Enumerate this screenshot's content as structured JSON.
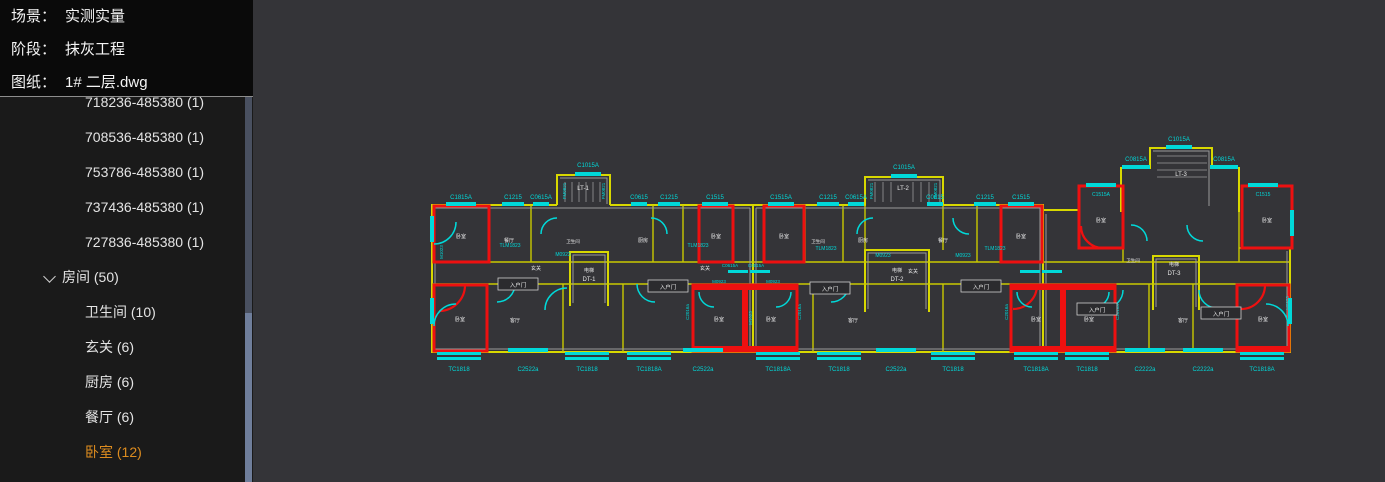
{
  "header": {
    "scene_label": "场景：",
    "scene_value": "实测实量",
    "stage_label": "阶段：",
    "stage_value": "抹灰工程",
    "drawing_label": "图纸：",
    "drawing_value": "1# 二层.dwg"
  },
  "theme": {
    "selected_item_color": "#dd8c1f",
    "sidebar_bg": "#1a1a1a",
    "canvas_bg": "#343438",
    "header_bg": "#0a0a0a",
    "cad_wall_yellow": "#d8d800",
    "cad_highlight_red": "#ee1010",
    "cad_window_cyan": "#00d9d9",
    "scrollbar_thumb": "#6f7e9b"
  },
  "sidebar": {
    "rows": [
      {
        "label": "718236-485380 (1)"
      },
      {
        "label": "708536-485380 (1)"
      },
      {
        "label": "753786-485380 (1)"
      },
      {
        "label": "737436-485380 (1)"
      },
      {
        "label": "727836-485380 (1)"
      },
      {
        "label": "房间 (50)"
      },
      {
        "label": "卫生间 (10)"
      },
      {
        "label": "玄关 (6)"
      },
      {
        "label": "厨房 (6)"
      },
      {
        "label": "餐厅 (6)"
      },
      {
        "label": "卧室 (12)"
      }
    ]
  },
  "plan": {
    "annotations": [
      {
        "t": "C1815A",
        "x": 208,
        "y": 199
      },
      {
        "t": "C1215",
        "x": 260,
        "y": 199
      },
      {
        "t": "C0615A",
        "x": 288,
        "y": 199
      },
      {
        "t": "C1015A",
        "x": 335,
        "y": 167
      },
      {
        "t": "C0615",
        "x": 386,
        "y": 199
      },
      {
        "t": "C1215",
        "x": 416,
        "y": 199
      },
      {
        "t": "C1515",
        "x": 462,
        "y": 199
      },
      {
        "t": "C1515A",
        "x": 528,
        "y": 199
      },
      {
        "t": "C1215",
        "x": 575,
        "y": 199
      },
      {
        "t": "C0615A",
        "x": 603,
        "y": 199
      },
      {
        "t": "C1015A",
        "x": 651,
        "y": 169
      },
      {
        "t": "C0615",
        "x": 682,
        "y": 199
      },
      {
        "t": "C1215",
        "x": 732,
        "y": 199
      },
      {
        "t": "C1515",
        "x": 768,
        "y": 199
      },
      {
        "t": "C0815A",
        "x": 883,
        "y": 161
      },
      {
        "t": "C1015A",
        "x": 926,
        "y": 141
      },
      {
        "t": "C0815A",
        "x": 971,
        "y": 161
      },
      {
        "t": "C1515A",
        "x": 848,
        "y": 196,
        "s": 5
      },
      {
        "t": "C1515",
        "x": 1010,
        "y": 196,
        "s": 5
      },
      {
        "t": "TC1818",
        "x": 206,
        "y": 371
      },
      {
        "t": "C2522a",
        "x": 275,
        "y": 371
      },
      {
        "t": "TC1818",
        "x": 334,
        "y": 371
      },
      {
        "t": "TC1818A",
        "x": 396,
        "y": 371
      },
      {
        "t": "C2522a",
        "x": 450,
        "y": 371
      },
      {
        "t": "TC1818A",
        "x": 525,
        "y": 371
      },
      {
        "t": "TC1818",
        "x": 586,
        "y": 371
      },
      {
        "t": "C2522a",
        "x": 643,
        "y": 371
      },
      {
        "t": "TC1818",
        "x": 700,
        "y": 371
      },
      {
        "t": "TC1818A",
        "x": 783,
        "y": 371
      },
      {
        "t": "TC1818",
        "x": 834,
        "y": 371
      },
      {
        "t": "C2222a",
        "x": 892,
        "y": 371
      },
      {
        "t": "C2222a",
        "x": 950,
        "y": 371
      },
      {
        "t": "TC1818A",
        "x": 1009,
        "y": 371
      },
      {
        "t": "C0615A",
        "x": 477,
        "y": 267,
        "s": 4.5
      },
      {
        "t": "C0515A",
        "x": 503,
        "y": 267,
        "s": 4.5
      },
      {
        "t": "TLM1823",
        "x": 257,
        "y": 247,
        "s": 5
      },
      {
        "t": "TLM1823",
        "x": 445,
        "y": 247,
        "s": 5
      },
      {
        "t": "TLM1823",
        "x": 573,
        "y": 250,
        "s": 5
      },
      {
        "t": "TLM1823",
        "x": 742,
        "y": 250,
        "s": 5
      },
      {
        "t": "M0923",
        "x": 310,
        "y": 256,
        "s": 5
      },
      {
        "t": "M0923",
        "x": 630,
        "y": 257,
        "s": 5
      },
      {
        "t": "M0923",
        "x": 710,
        "y": 257,
        "s": 5
      },
      {
        "t": "M0923",
        "x": 466,
        "y": 283,
        "s": 4.5
      },
      {
        "t": "M0923",
        "x": 520,
        "y": 283,
        "s": 4.5
      },
      {
        "t": "M1023",
        "x": 190,
        "y": 252,
        "r": 1,
        "s": 4.5
      },
      {
        "t": "M1023",
        "x": 499,
        "y": 318,
        "r": 1,
        "s": 4.5
      },
      {
        "t": "M0923",
        "x": 1036,
        "y": 303,
        "r": 1,
        "s": 4.5
      },
      {
        "t": "C2016a",
        "x": 436,
        "y": 312,
        "r": 1,
        "s": 4.5
      },
      {
        "t": "C2016a",
        "x": 548,
        "y": 312,
        "r": 1,
        "s": 4.5
      },
      {
        "t": "C2016a",
        "x": 755,
        "y": 312,
        "r": 1,
        "s": 4.5
      },
      {
        "t": "C2016a",
        "x": 866,
        "y": 312,
        "r": 1,
        "s": 4.5
      },
      {
        "t": "FM0821",
        "x": 313,
        "y": 191,
        "r": 1,
        "s": 4.5
      },
      {
        "t": "FM0821",
        "x": 352,
        "y": 191,
        "r": 1,
        "s": 4.5
      },
      {
        "t": "FM0821",
        "x": 620,
        "y": 191,
        "r": 1,
        "s": 4.5
      },
      {
        "t": "FM0821",
        "x": 684,
        "y": 191,
        "r": 1,
        "s": 4.5
      },
      {
        "t": "LT-1",
        "x": 330,
        "y": 190,
        "c": "wh",
        "s": 6
      },
      {
        "t": "LT-2",
        "x": 650,
        "y": 190,
        "c": "wh",
        "s": 6
      },
      {
        "t": "LT-3",
        "x": 928,
        "y": 176,
        "c": "wh",
        "s": 6
      },
      {
        "t": "电梯",
        "x": 336,
        "y": 272,
        "c": "wh",
        "s": 5
      },
      {
        "t": "DT-1",
        "x": 336,
        "y": 281,
        "c": "wh",
        "s": 6
      },
      {
        "t": "电梯",
        "x": 644,
        "y": 272,
        "c": "wh",
        "s": 5
      },
      {
        "t": "DT-2",
        "x": 644,
        "y": 281,
        "c": "wh",
        "s": 6
      },
      {
        "t": "电梯",
        "x": 921,
        "y": 266,
        "c": "wh",
        "s": 5
      },
      {
        "t": "DT-3",
        "x": 921,
        "y": 275,
        "c": "wh",
        "s": 6
      },
      {
        "t": "卧室",
        "x": 208,
        "y": 238,
        "c": "wh",
        "s": 5
      },
      {
        "t": "卧室",
        "x": 207,
        "y": 321,
        "c": "wh",
        "s": 5
      },
      {
        "t": "卧室",
        "x": 463,
        "y": 238,
        "c": "wh",
        "s": 5
      },
      {
        "t": "卧室",
        "x": 466,
        "y": 321,
        "c": "wh",
        "s": 5
      },
      {
        "t": "卧室",
        "x": 518,
        "y": 321,
        "c": "wh",
        "s": 5
      },
      {
        "t": "卧室",
        "x": 531,
        "y": 238,
        "c": "wh",
        "s": 5
      },
      {
        "t": "卧室",
        "x": 768,
        "y": 238,
        "c": "wh",
        "s": 5
      },
      {
        "t": "卧室",
        "x": 783,
        "y": 321,
        "c": "wh",
        "s": 5
      },
      {
        "t": "卧室",
        "x": 836,
        "y": 321,
        "c": "wh",
        "s": 5
      },
      {
        "t": "卧室",
        "x": 848,
        "y": 222,
        "c": "wh",
        "s": 5
      },
      {
        "t": "卧室",
        "x": 1014,
        "y": 222,
        "c": "wh",
        "s": 5
      },
      {
        "t": "卧室",
        "x": 1010,
        "y": 321,
        "c": "wh",
        "s": 5
      },
      {
        "t": "客厅",
        "x": 262,
        "y": 322,
        "c": "wh",
        "s": 5
      },
      {
        "t": "客厅",
        "x": 600,
        "y": 322,
        "c": "wh",
        "s": 5
      },
      {
        "t": "客厅",
        "x": 930,
        "y": 322,
        "c": "wh",
        "s": 5
      },
      {
        "t": "餐厅",
        "x": 256,
        "y": 242,
        "c": "wh",
        "s": 5
      },
      {
        "t": "餐厅",
        "x": 690,
        "y": 242,
        "c": "wh",
        "s": 5
      },
      {
        "t": "厨房",
        "x": 390,
        "y": 242,
        "c": "wh",
        "s": 5
      },
      {
        "t": "厨房",
        "x": 610,
        "y": 242,
        "c": "wh",
        "s": 5
      },
      {
        "t": "玄关",
        "x": 283,
        "y": 270,
        "c": "wh",
        "s": 5
      },
      {
        "t": "玄关",
        "x": 452,
        "y": 270,
        "c": "wh",
        "s": 5
      },
      {
        "t": "玄关",
        "x": 660,
        "y": 273,
        "c": "wh",
        "s": 5
      },
      {
        "t": "卫生间",
        "x": 320,
        "y": 243,
        "c": "wh",
        "s": 4.5
      },
      {
        "t": "卫生间",
        "x": 565,
        "y": 243,
        "c": "wh",
        "s": 4.5
      },
      {
        "t": "卫生间",
        "x": 880,
        "y": 262,
        "c": "wh",
        "s": 4.5
      },
      {
        "t": "入户门",
        "x": 265,
        "y": 286,
        "c": "wh",
        "s": 5.5,
        "box": 1
      },
      {
        "t": "入户门",
        "x": 415,
        "y": 288,
        "c": "wh",
        "s": 5.5,
        "box": 1
      },
      {
        "t": "入户门",
        "x": 577,
        "y": 290,
        "c": "wh",
        "s": 5.5,
        "box": 1
      },
      {
        "t": "入户门",
        "x": 728,
        "y": 288,
        "c": "wh",
        "s": 5.5,
        "box": 1
      },
      {
        "t": "入户门",
        "x": 844,
        "y": 311,
        "c": "wh",
        "s": 5.5,
        "box": 1
      },
      {
        "t": "入户门",
        "x": 968,
        "y": 315,
        "c": "wh",
        "s": 5.5,
        "box": 1
      }
    ],
    "windows": [
      {
        "x": 193,
        "y": 202,
        "w": 30,
        "h": 4
      },
      {
        "x": 249,
        "y": 202,
        "w": 22,
        "h": 4
      },
      {
        "x": 280,
        "y": 202,
        "w": 16,
        "h": 4
      },
      {
        "x": 322,
        "y": 172,
        "w": 26,
        "h": 4
      },
      {
        "x": 378,
        "y": 202,
        "w": 16,
        "h": 4
      },
      {
        "x": 405,
        "y": 202,
        "w": 22,
        "h": 4
      },
      {
        "x": 449,
        "y": 202,
        "w": 26,
        "h": 4
      },
      {
        "x": 515,
        "y": 202,
        "w": 26,
        "h": 4
      },
      {
        "x": 564,
        "y": 202,
        "w": 22,
        "h": 4
      },
      {
        "x": 595,
        "y": 202,
        "w": 16,
        "h": 4
      },
      {
        "x": 638,
        "y": 174,
        "w": 26,
        "h": 4
      },
      {
        "x": 674,
        "y": 202,
        "w": 16,
        "h": 4
      },
      {
        "x": 721,
        "y": 202,
        "w": 22,
        "h": 4
      },
      {
        "x": 755,
        "y": 202,
        "w": 26,
        "h": 4
      },
      {
        "x": 869,
        "y": 165,
        "w": 28,
        "h": 4
      },
      {
        "x": 913,
        "y": 145,
        "w": 26,
        "h": 4
      },
      {
        "x": 957,
        "y": 165,
        "w": 28,
        "h": 4
      },
      {
        "x": 833,
        "y": 183,
        "w": 30,
        "h": 4
      },
      {
        "x": 995,
        "y": 183,
        "w": 30,
        "h": 4
      },
      {
        "x": 255,
        "y": 348,
        "w": 40,
        "h": 4
      },
      {
        "x": 430,
        "y": 348,
        "w": 40,
        "h": 4
      },
      {
        "x": 623,
        "y": 348,
        "w": 40,
        "h": 4
      },
      {
        "x": 872,
        "y": 348,
        "w": 40,
        "h": 4
      },
      {
        "x": 930,
        "y": 348,
        "w": 40,
        "h": 4
      },
      {
        "x": 184,
        "y": 352,
        "w": 44,
        "h": 3
      },
      {
        "x": 184,
        "y": 357,
        "w": 44,
        "h": 3
      },
      {
        "x": 312,
        "y": 352,
        "w": 44,
        "h": 3
      },
      {
        "x": 312,
        "y": 357,
        "w": 44,
        "h": 3
      },
      {
        "x": 374,
        "y": 352,
        "w": 44,
        "h": 3
      },
      {
        "x": 374,
        "y": 357,
        "w": 44,
        "h": 3
      },
      {
        "x": 503,
        "y": 352,
        "w": 44,
        "h": 3
      },
      {
        "x": 503,
        "y": 357,
        "w": 44,
        "h": 3
      },
      {
        "x": 564,
        "y": 352,
        "w": 44,
        "h": 3
      },
      {
        "x": 564,
        "y": 357,
        "w": 44,
        "h": 3
      },
      {
        "x": 678,
        "y": 352,
        "w": 44,
        "h": 3
      },
      {
        "x": 678,
        "y": 357,
        "w": 44,
        "h": 3
      },
      {
        "x": 761,
        "y": 352,
        "w": 44,
        "h": 3
      },
      {
        "x": 761,
        "y": 357,
        "w": 44,
        "h": 3
      },
      {
        "x": 812,
        "y": 352,
        "w": 44,
        "h": 3
      },
      {
        "x": 812,
        "y": 357,
        "w": 44,
        "h": 3
      },
      {
        "x": 987,
        "y": 352,
        "w": 44,
        "h": 3
      },
      {
        "x": 987,
        "y": 357,
        "w": 44,
        "h": 3
      },
      {
        "x": 177,
        "y": 216,
        "w": 4,
        "h": 26
      },
      {
        "x": 177,
        "y": 298,
        "w": 4,
        "h": 26
      },
      {
        "x": 1035,
        "y": 298,
        "w": 4,
        "h": 26
      },
      {
        "x": 1037,
        "y": 210,
        "w": 4,
        "h": 26
      },
      {
        "x": 475,
        "y": 270,
        "w": 20,
        "h": 3
      },
      {
        "x": 497,
        "y": 270,
        "w": 20,
        "h": 3
      },
      {
        "x": 767,
        "y": 270,
        "w": 20,
        "h": 3
      },
      {
        "x": 789,
        "y": 270,
        "w": 20,
        "h": 3
      }
    ]
  }
}
